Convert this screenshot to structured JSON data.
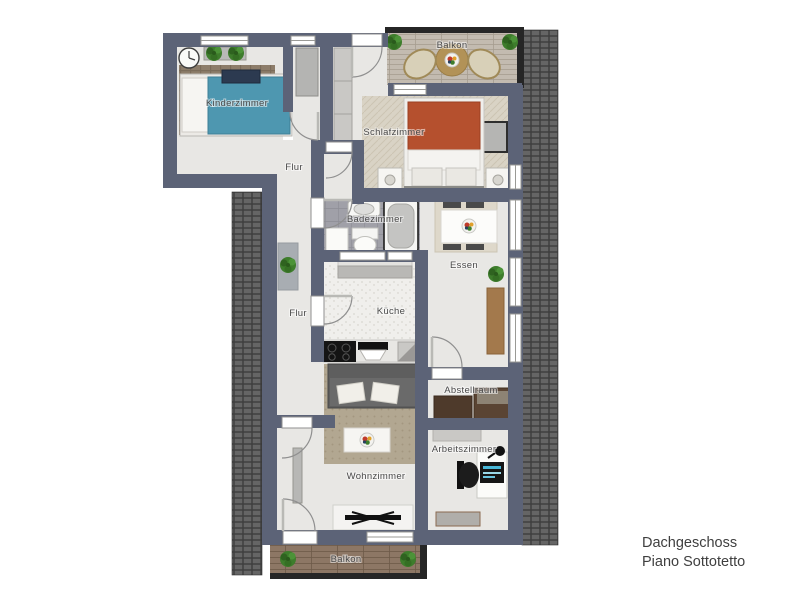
{
  "title": {
    "line1": "Dachgeschoss",
    "line2": "Piano Sottotetto"
  },
  "rooms": {
    "kinderzimmer": "Kinderzimmer",
    "schlafzimmer": "Schlafzimmer",
    "balkon_top": "Balkon",
    "flur_upper": "Flur",
    "badezimmer": "Badezimmer",
    "essen": "Essen",
    "kueche": "Küche",
    "flur_lower": "Flur",
    "wohnzimmer": "Wohnzimmer",
    "abstellraum": "Abstellraum",
    "arbeitszimmer": "Arbeitszimmer",
    "balkon_bottom": "Balkon"
  },
  "colors": {
    "wall": "#5c6377",
    "floor": "#e8e7e4",
    "roof_tiles": "#4a4a4a",
    "bathroom_tiles": "#a0a0a8",
    "child_bed": "#4e97b0",
    "double_bed": "#b5502e",
    "wood_furniture": "#a3794c",
    "balcony_deck_top": "#c3bbb0",
    "balcony_deck_bottom": "#8d7765",
    "plants": "#3e7d2c",
    "label_text": "#4a4a4a",
    "title_text": "#3f3f3f"
  },
  "furniture": [
    "wall-clock",
    "plant-shelf",
    "child-bed",
    "hall-wardrobe",
    "schlafzimmer-closet",
    "double-bed",
    "nightstands",
    "dresser",
    "balcony-table",
    "balcony-chairs",
    "bathroom-sink",
    "bathtub",
    "toilet",
    "washing-machine",
    "kitchen-island",
    "kitchen-counter",
    "cooktop",
    "kitchen-sink",
    "dining-table",
    "dining-chairs",
    "sideboard",
    "potted-plants",
    "doormat",
    "sofa",
    "coffee-table",
    "tv-lowboard",
    "tv",
    "storage-cabinets",
    "desk",
    "office-chair",
    "monitor",
    "desk-lamp",
    "office-rug",
    "livingroom-wardrobe"
  ]
}
